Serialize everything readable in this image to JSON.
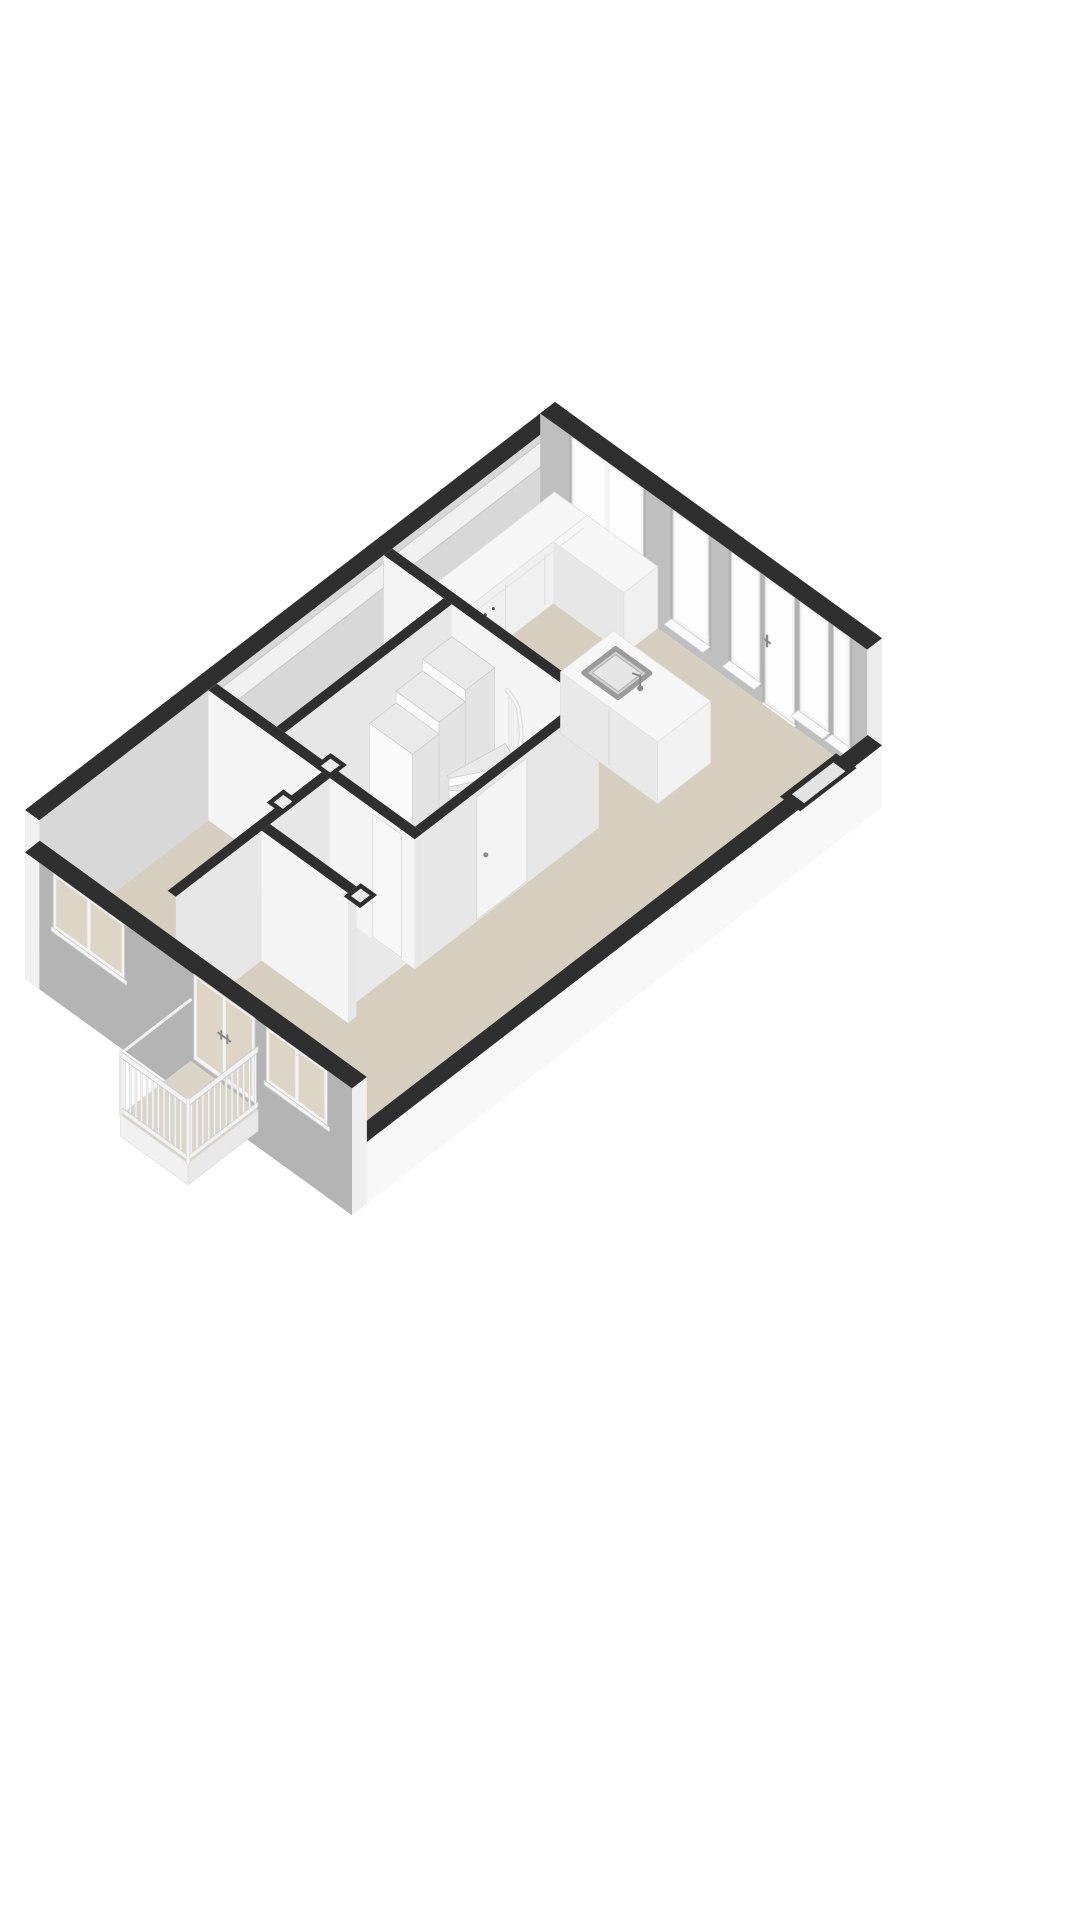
{
  "palette": {
    "background": "#ffffff",
    "wallCap": "#2f2f2f",
    "floorMain": "#d6cfc0",
    "floorLight": "#e9e9e9",
    "nwFace": "#d8d8d8",
    "neFace": "#bfbfbf",
    "facade": "#b4b4b4",
    "exteriorWhite": "#f8f8f8",
    "intLit": "#f5f5f5",
    "intShade": "#e7e7e7",
    "frame": "#f4f4f4",
    "glassIn": "#fdfdfd",
    "glassOut": "#ddd5c6",
    "counterFace": "#f0f0f0",
    "counterTop": "#f7f7f7",
    "counterSide": "#e7e7e7",
    "stairTread": "#eaeaea",
    "stairRiser": "#fafafa",
    "railMid": "#e0e0e0",
    "railHi": "#f7f7f7",
    "hardware": "#8a8a8a",
    "sinkRim": "#9b9b9b",
    "sinkBasin": "#d2d2d2",
    "transom": "#f1f1f1",
    "nicheInner": "#e4e4e4"
  },
  "scene": {
    "kind": "axonometric-3d-floorplan",
    "storey": "single level, walls cut low, viewed from above at an angle",
    "rooms": [
      {
        "id": "living-kitchen",
        "floor": "beige"
      },
      {
        "id": "bedroom",
        "floor": "beige"
      },
      {
        "id": "hallway",
        "floor": "light"
      },
      {
        "id": "stair-room",
        "floor": "light"
      },
      {
        "id": "storage-room",
        "floor": "light"
      }
    ],
    "fixtures": [
      "kitchen-counter-with-cooktop-knobs",
      "kitchen-island-with-sink-and-faucet",
      "winder-staircase-with-baluster-railing",
      "balcony-with-baluster-railing",
      "interior-door-with-handle-under-stairs",
      "hall-door",
      "vent-shafts-in-wall-junctions"
    ],
    "openings": {
      "ne_wall": [
        "double-window",
        "tall-window",
        "tall-window",
        "glass-door-with-handle",
        "tall-window",
        "corner-window"
      ],
      "sw_facade": [
        "double-window",
        "french-balcony-doors-with-handles",
        "double-window"
      ],
      "se_wall": [
        "recessed-low-window-niche"
      ],
      "nw_wall": [
        "transom-light-band"
      ]
    }
  }
}
